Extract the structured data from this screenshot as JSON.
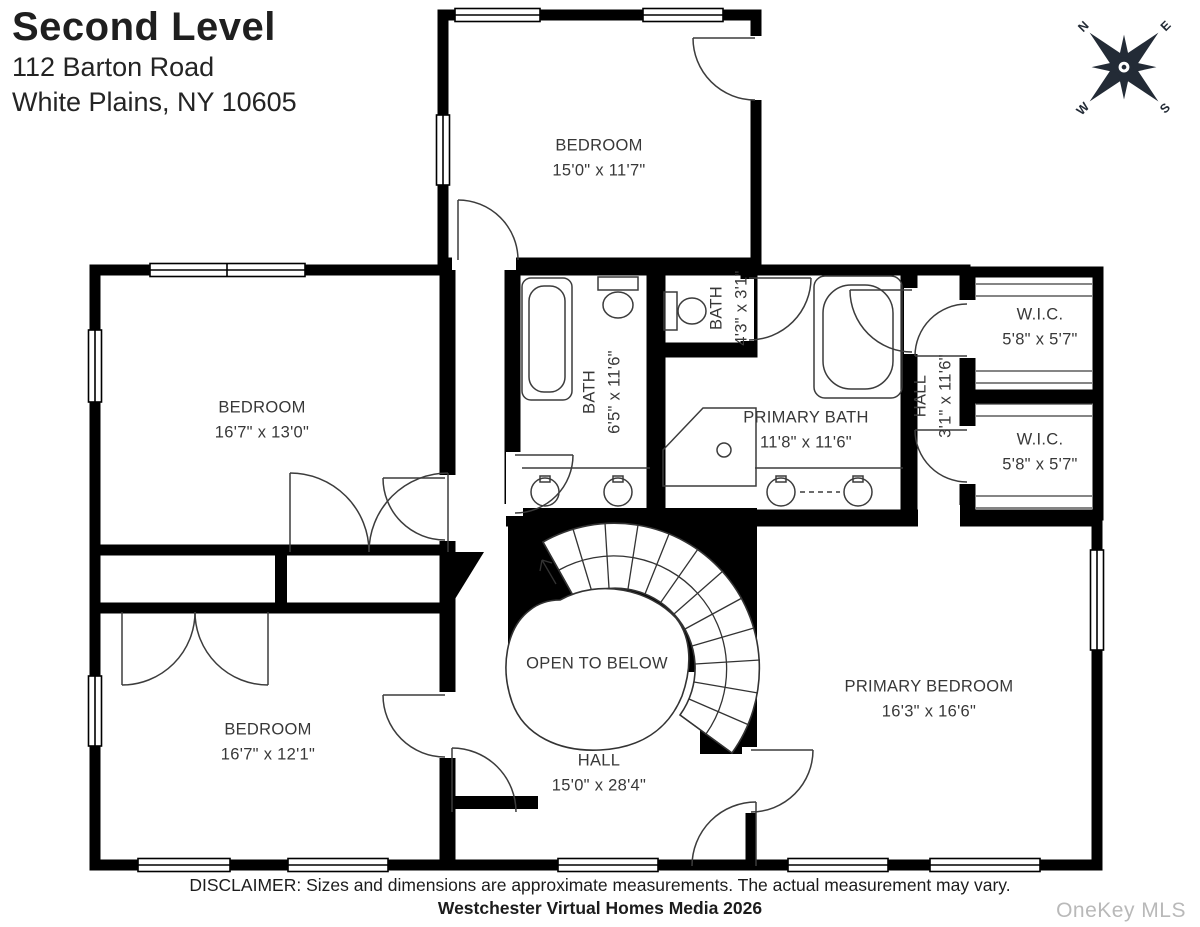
{
  "header": {
    "title": "Second Level",
    "address_line1": "112 Barton Road",
    "address_line2": "White Plains, NY 10605"
  },
  "compass": {
    "n": "N",
    "e": "E",
    "s": "S",
    "w": "W"
  },
  "rooms": {
    "bedroom_top": {
      "name": "BEDROOM",
      "dims": "15'0\" x 11'7\""
    },
    "bedroom_left": {
      "name": "BEDROOM",
      "dims": "16'7\" x 13'0\""
    },
    "bath_main": {
      "name": "BATH",
      "dims": "6'5\" x 11'6\""
    },
    "bath_small": {
      "name": "BATH",
      "dims": "4'3\" x 3'1\""
    },
    "primary_bath": {
      "name": "PRIMARY BATH",
      "dims": "11'8\" x 11'6\""
    },
    "hall_upper": {
      "name": "HALL",
      "dims": "3'1\" x 11'6\""
    },
    "wic_top": {
      "name": "W.I.C.",
      "dims": "5'8\" x 5'7\""
    },
    "wic_bottom": {
      "name": "W.I.C.",
      "dims": "5'8\" x 5'7\""
    },
    "open_to_below": {
      "name": "OPEN TO BELOW"
    },
    "primary_bedroom": {
      "name": "PRIMARY BEDROOM",
      "dims": "16'3\" x 16'6\""
    },
    "bedroom_bottom_left": {
      "name": "BEDROOM",
      "dims": "16'7\" x 12'1\""
    },
    "hall_main": {
      "name": "HALL",
      "dims": "15'0\" x 28'4\""
    }
  },
  "footer": {
    "disclaimer": "DISCLAIMER: Sizes and dimensions are approximate measurements. The actual measurement may vary.",
    "credit": "Westchester Virtual Homes Media 2026",
    "watermark": "OneKey MLS"
  },
  "colors": {
    "wall": "#000000",
    "label": "#383838",
    "compass": "#232b36",
    "watermark": "#b9b9b9"
  }
}
